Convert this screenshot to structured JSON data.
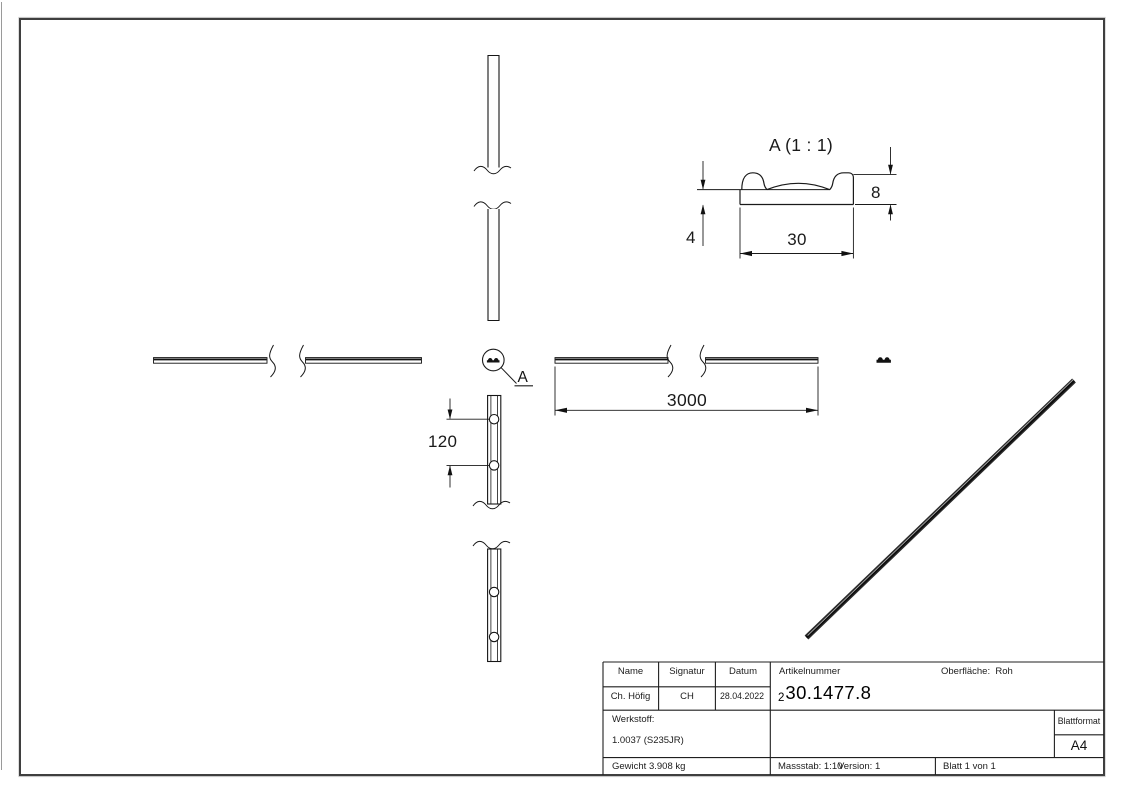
{
  "sheet": {
    "background": "#ffffff",
    "frame_color": "#3f3f3f",
    "line_color": "#1a1a1a"
  },
  "detail_view": {
    "title": "A (1 : 1)",
    "profile_height": "8",
    "profile_base": "4",
    "profile_width": "30"
  },
  "main_views": {
    "bar_length": "3000",
    "hole_spacing": "120",
    "detail_marker": "A"
  },
  "title_block": {
    "name_label": "Name",
    "signatur_label": "Signatur",
    "datum_label": "Datum",
    "name_value": "Ch. Höfig",
    "signatur_value": "CH",
    "datum_value": "28.04.2022",
    "artikelnummer_label": "Artikelnummer",
    "artikelnummer_prefix": "2",
    "artikelnummer_value": "30.1477.8",
    "oberflaeche_label": "Oberfläche:",
    "oberflaeche_value": "Roh",
    "werkstoff_label": "Werkstoff:",
    "werkstoff_value": "1.0037 (S235JR)",
    "blattformat_label": "Blattformat",
    "blattformat_value": "A4",
    "gewicht": "Gewicht 3.908 kg",
    "massstab": "Massstab: 1:10",
    "version": "Version: 1",
    "blatt": "Blatt 1 von 1"
  }
}
